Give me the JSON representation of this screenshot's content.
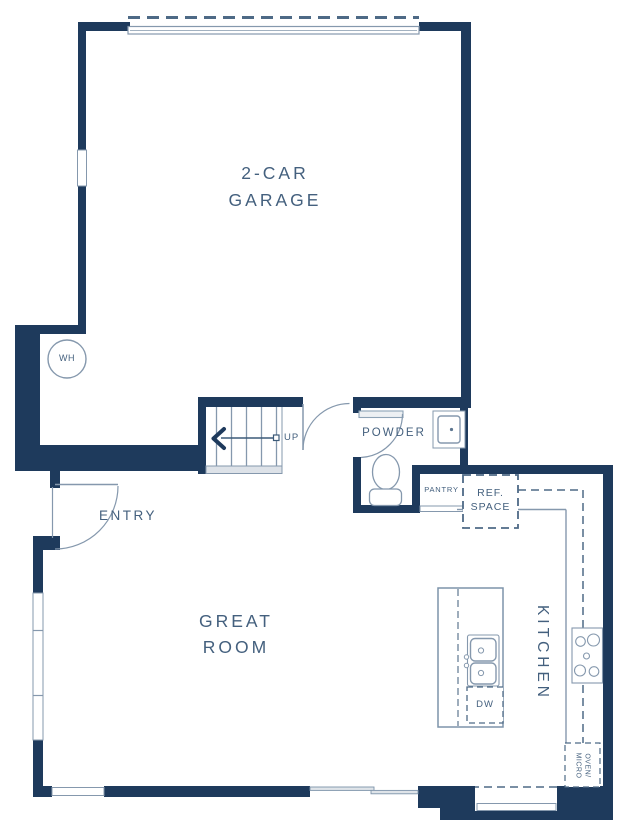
{
  "plan": {
    "rooms": {
      "garage": {
        "label_line1": "2-CAR",
        "label_line2": "GARAGE"
      },
      "great_room": {
        "label_line1": "GREAT",
        "label_line2": "ROOM"
      },
      "kitchen": {
        "label": "KITCHEN"
      },
      "powder": {
        "label": "POWDER"
      },
      "entry": {
        "label": "ENTRY"
      },
      "pantry": {
        "label": "PANTRY"
      }
    },
    "fixtures": {
      "water_heater": "WH",
      "stairs_direction": "UP",
      "dishwasher": "DW",
      "ref_space_line1": "REF.",
      "ref_space_line2": "SPACE",
      "oven_micro_line1": "OVEN/",
      "oven_micro_line2": "MICRO"
    },
    "colors": {
      "wall": "#1e3a5c",
      "label_text": "#44607e",
      "fixture_line": "#8598ad",
      "dash_line": "#4e6a86",
      "light_fill": "#e9edf1",
      "background": "#ffffff"
    }
  }
}
